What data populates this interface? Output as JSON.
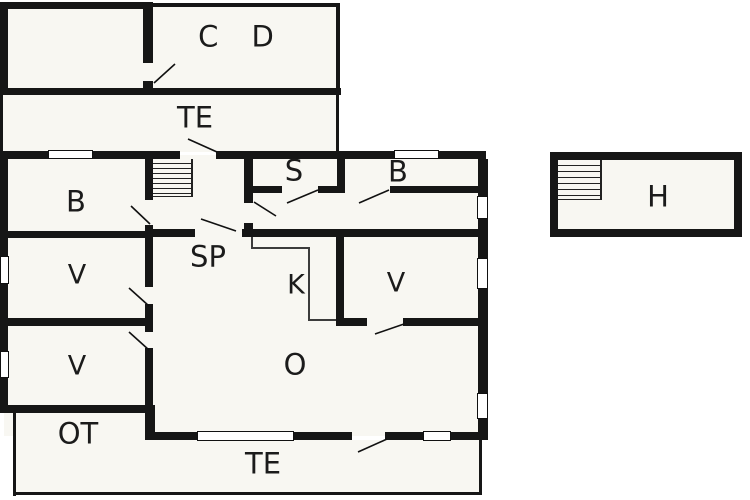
{
  "title": "Floor plan",
  "colors": {
    "wall": "#161616",
    "floor": "#f8f7f2",
    "thin_line": "#3c3c3c",
    "label": "#1b1b1b",
    "background": "#ffffff"
  },
  "rooms": {
    "cd": "C D",
    "te_upper": "TE",
    "b_left": "B",
    "s": "S",
    "b_right": "B",
    "sp": "SP",
    "k": "K",
    "v_right": "V",
    "v_upper": "V",
    "v_lower": "V",
    "o": "O",
    "ot": "OT",
    "te_lower": "TE",
    "h": "H"
  }
}
